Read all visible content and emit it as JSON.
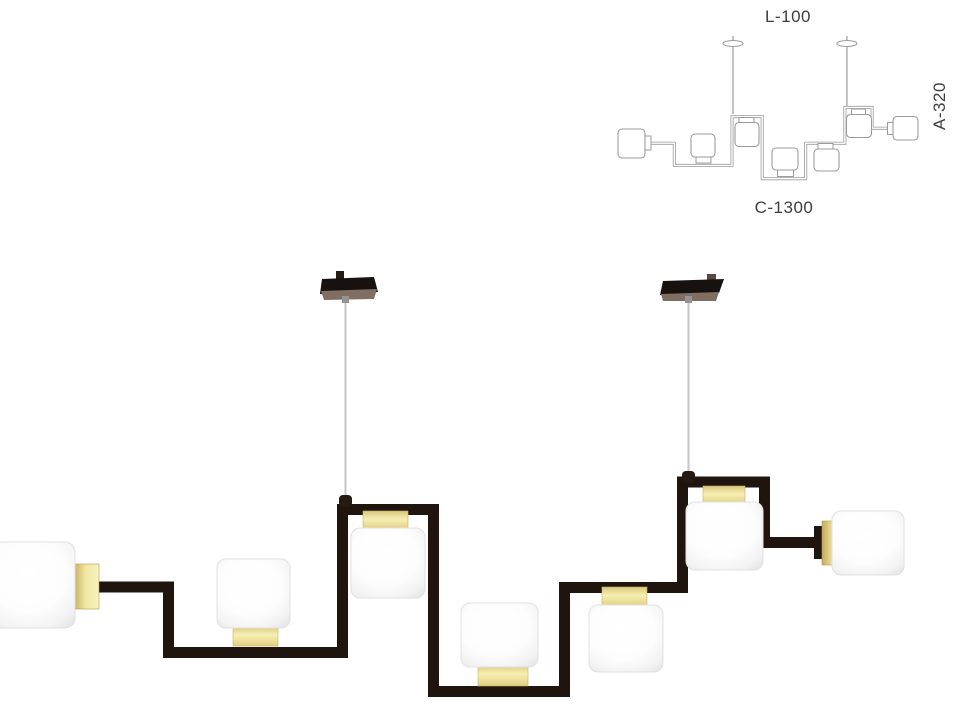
{
  "diagram": {
    "labels": {
      "l": "L-100",
      "a": "A-320",
      "c": "C-1300"
    },
    "line_color": "#9b9b9b",
    "label_color": "#3e3e3c"
  },
  "fixture": {
    "shade_count": 7,
    "canopy_count": 2,
    "colors": {
      "frame": "#20140f",
      "brass_light": "#f3eaa8",
      "brass_dark": "#c4a95c",
      "glass": "#ffffff",
      "cable": "#c4c6c8",
      "canopy": "#171210",
      "canopy_rim": "#7f6e61"
    }
  }
}
